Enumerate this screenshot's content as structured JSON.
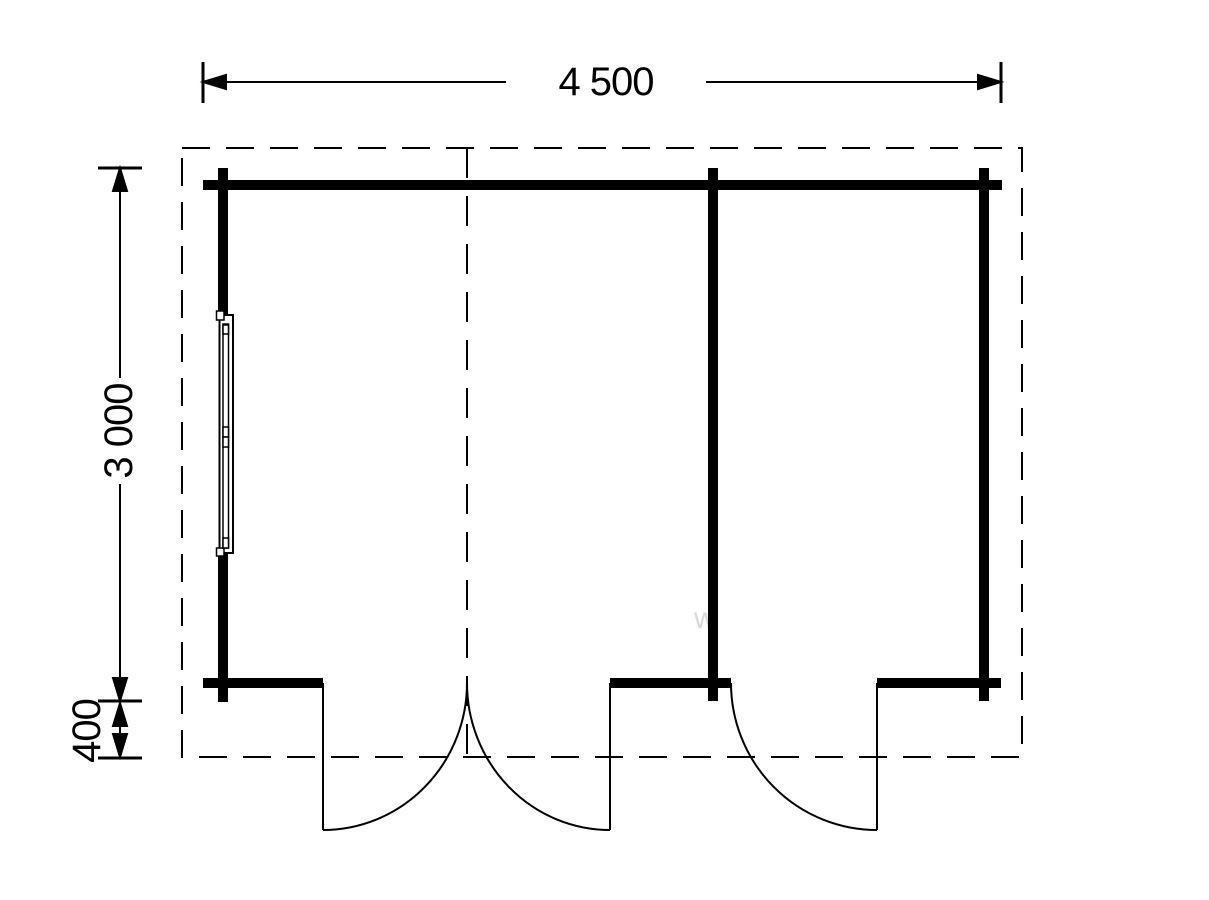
{
  "drawing": {
    "type": "floor-plan",
    "colors": {
      "line": "#000000",
      "background": "#ffffff",
      "watermark": "#d8d8d8"
    }
  },
  "dimensions": {
    "width": {
      "label": "4 500"
    },
    "height": {
      "label": "3 000"
    },
    "overhang": {
      "label": "400"
    }
  },
  "watermark": {
    "text": "w"
  }
}
